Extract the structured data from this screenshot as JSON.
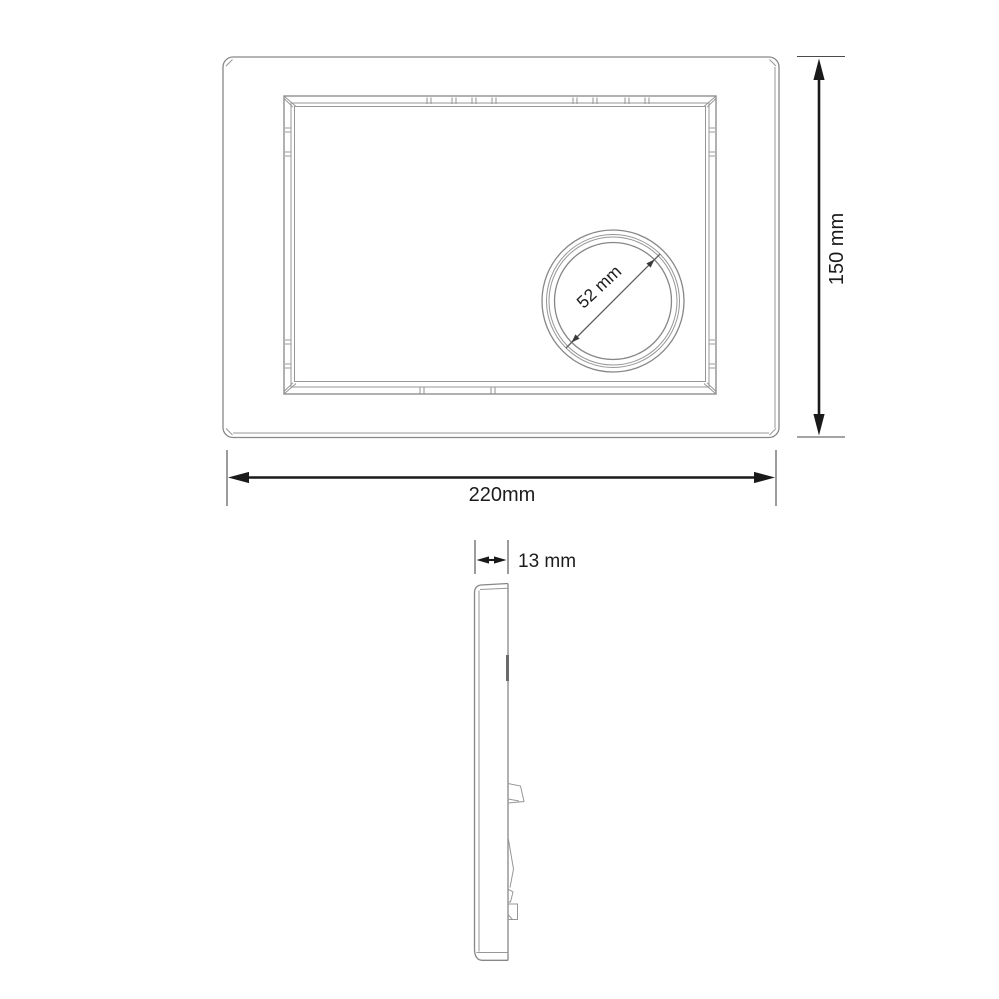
{
  "drawing": {
    "background_color": "#ffffff",
    "outline_color": "#878787",
    "dimension_color": "#1a1a1a",
    "views": {
      "front": {
        "width": {
          "value": 220,
          "unit": "mm",
          "label": "220mm"
        },
        "height": {
          "value": 150,
          "unit": "mm",
          "label": "150 mm"
        },
        "button_diameter": {
          "value": 52,
          "unit": "mm",
          "label": "52 mm"
        }
      },
      "side": {
        "depth": {
          "value": 13,
          "unit": "mm",
          "label": "13 mm"
        }
      }
    }
  }
}
